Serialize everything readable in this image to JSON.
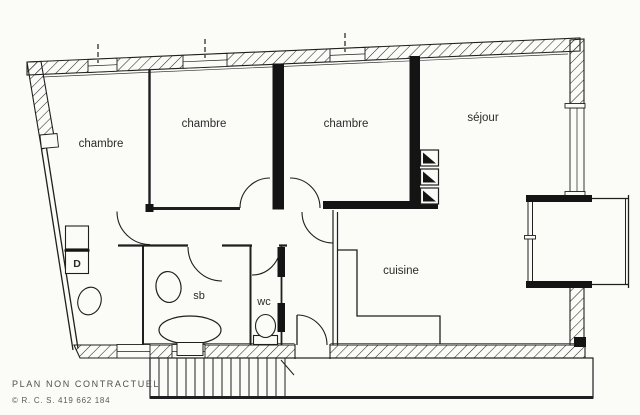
{
  "plan": {
    "rooms": {
      "chambre_1": {
        "label": "chambre"
      },
      "chambre_2": {
        "label": "chambre"
      },
      "chambre_3": {
        "label": "chambre"
      },
      "sejour": {
        "label": "séjour"
      },
      "cuisine": {
        "label": "cuisine"
      },
      "salle_de_bains": {
        "label": "sb"
      },
      "wc": {
        "label": "wc"
      },
      "closet": {
        "label": "D"
      }
    },
    "footer": {
      "disclaimer": "PLAN NON CONTRACTUEL",
      "rcs": "© R. C. S. 419 662 184"
    },
    "colors": {
      "paper": "#fbfbf8",
      "ink": "#1f1f1f",
      "bearing_wall": "#141414",
      "footer_text": "#4f4f4f"
    },
    "icons": {
      "fixtures": [
        "bathtub",
        "washbasin",
        "toilet",
        "heater",
        "staircase",
        "door-arc",
        "window"
      ]
    }
  }
}
